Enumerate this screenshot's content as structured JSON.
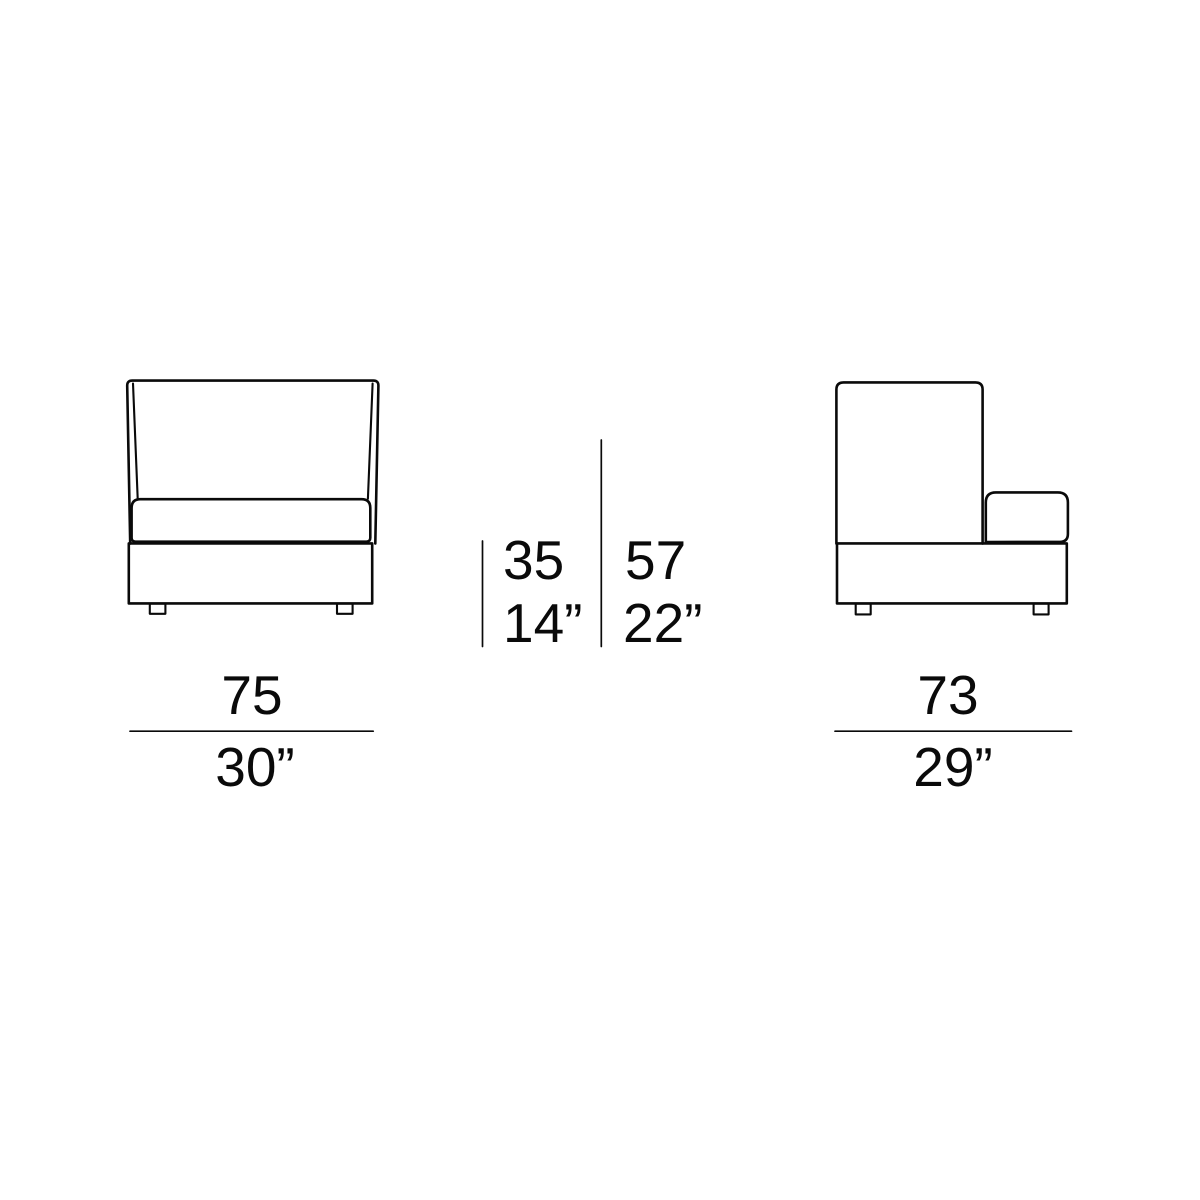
{
  "canvas": {
    "background": "#ffffff",
    "line_color": "#0a0a0a"
  },
  "drawing": {
    "front_view": {
      "name": "sofa module front view",
      "width": {
        "cm": "75",
        "inches": "30”"
      }
    },
    "side_view": {
      "name": "sofa module side view",
      "width": {
        "cm": "73",
        "inches": "29”"
      }
    },
    "heights": {
      "seat_height": {
        "cm": "35",
        "inches": "14”"
      },
      "overall_height": {
        "cm": "57",
        "inches": "22”"
      }
    }
  }
}
